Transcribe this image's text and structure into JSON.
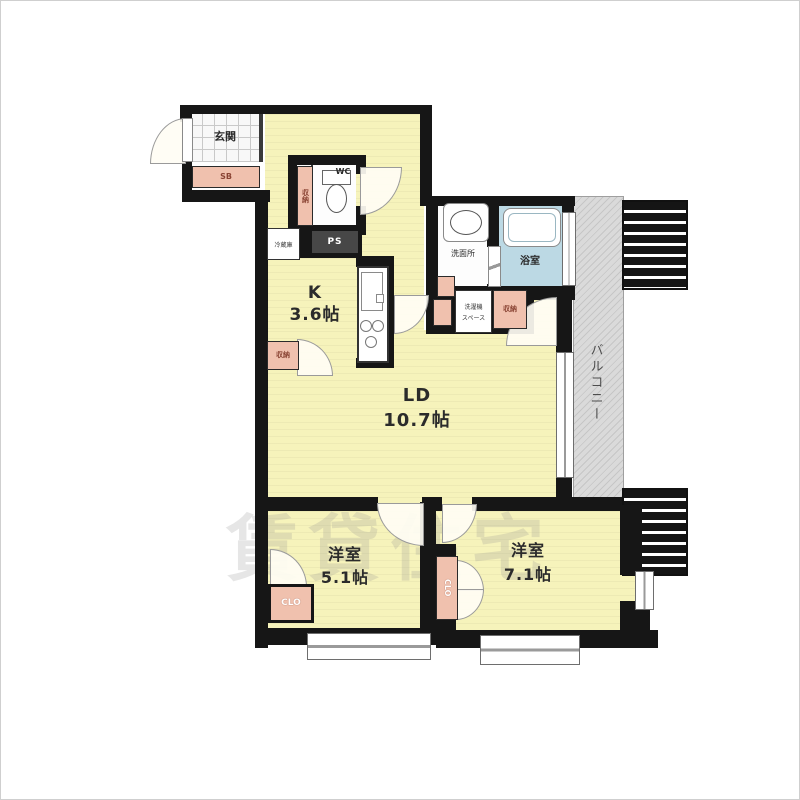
{
  "watermark": "賃貸住宅",
  "rooms": {
    "entrance": "玄関",
    "shoe_box": "SB",
    "toilet": "WC",
    "hall_storage": "収納",
    "kitchen_type": "K",
    "kitchen_area": "3.6帖",
    "fridge": "冷蔵庫",
    "pipe_space": "PS",
    "kitchen_storage": "収納",
    "washroom": "洗面所",
    "washer_line1": "洗濯機",
    "washer_line2": "スペース",
    "washroom_storage": "収納",
    "bathroom": "浴室",
    "living_type": "LD",
    "living_area": "10.7帖",
    "balcony": "バルコニー",
    "bedroom1_type": "洋室",
    "bedroom1_area": "5.1帖",
    "bedroom1_closet": "CLO",
    "bedroom2_type": "洋室",
    "bedroom2_area": "7.1帖",
    "bedroom2_closet": "CLO"
  },
  "colors": {
    "floor_yellow": "#f6f3bb",
    "wall_black": "#161616",
    "bath_blue": "#bcd9e4",
    "balcony_gray": "#dadada",
    "closet_pink": "#f0c1ae"
  }
}
